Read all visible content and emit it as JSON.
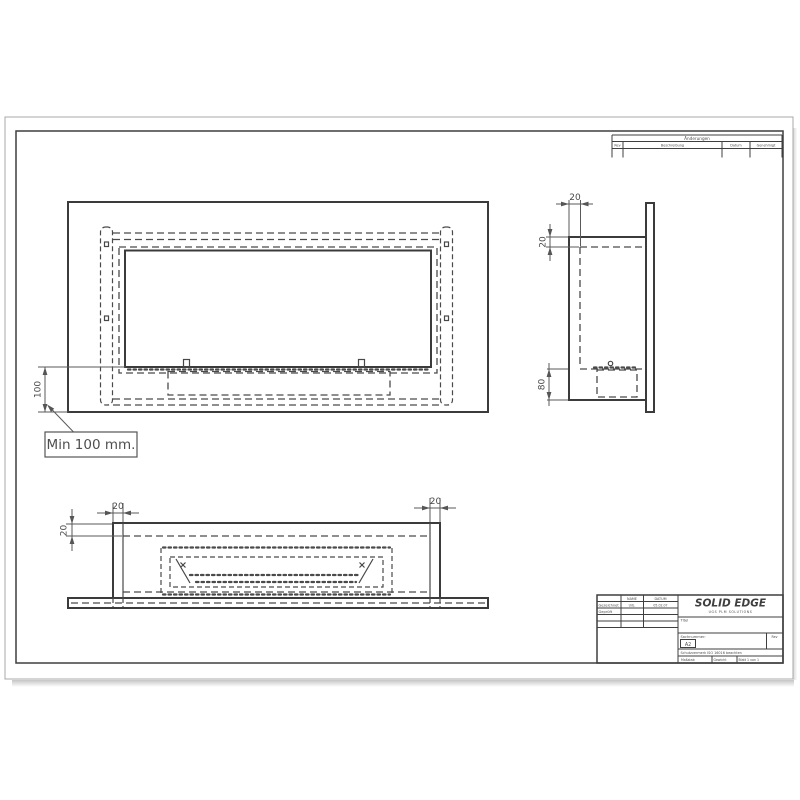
{
  "dims": {
    "front_height": "100",
    "side_wall": "20",
    "side_top": "20",
    "side_burner": "80",
    "bottom_wall_left": "20",
    "bottom_wall_right": "20",
    "bottom_depth": "20"
  },
  "callout": {
    "text": "Min 100 mm."
  },
  "revision_table": {
    "title": "Änderungen",
    "col_rev": "Rev",
    "col_desc": "Beschreibung",
    "col_date": "Datum",
    "col_appr": "Genehmigt"
  },
  "title_block": {
    "logo": "SOLID EDGE",
    "logo_sub": "UGS PLM SOLUTIONS",
    "col_name": "NAME",
    "col_date": "DATUM",
    "row1_label": "Gezeichnet",
    "row1_name": "Urb.",
    "row1_date": "05.02.07",
    "row2_label": "Geprüft",
    "titel_label": "Titel",
    "sach_label": "Sachnummer:",
    "size": "A2",
    "rev_label": "Rev",
    "schutz": "Schutzvermerk ISO 16016 beachten",
    "scale_label": "Maßstab",
    "weight_label": "Gewicht",
    "sheet_label": "Blatt 1 von 1"
  }
}
